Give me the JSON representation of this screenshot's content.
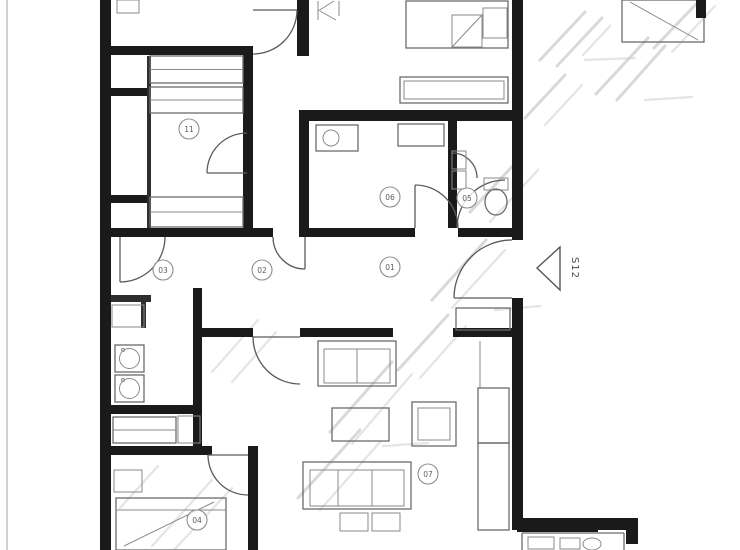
{
  "image": {
    "description": "Scanned black-and-white architectural apartment floor plan with diagonal watermark strokes, cropped at top and bottom edges",
    "width": 740,
    "height": 550
  },
  "plan": {
    "unit_label": "S12",
    "room_labels": [
      {
        "number": "11"
      },
      {
        "number": "03"
      },
      {
        "number": "02"
      },
      {
        "number": "01"
      },
      {
        "number": "06"
      },
      {
        "number": "05"
      },
      {
        "number": "07"
      },
      {
        "number": "04"
      }
    ],
    "symbols": [
      "wardrobe-hangers",
      "washing-machine",
      "double-bed",
      "sofa",
      "armchair",
      "coffee-table",
      "toilet",
      "sink",
      "shelving",
      "door-swing",
      "entry-arrow"
    ],
    "colors": {
      "walls": "#1a1a1a",
      "furniture_lines": "#6b6b6b",
      "watermark": "#b9b9b9",
      "background": "#ffffff"
    },
    "watermark": {
      "legible": false
    }
  }
}
